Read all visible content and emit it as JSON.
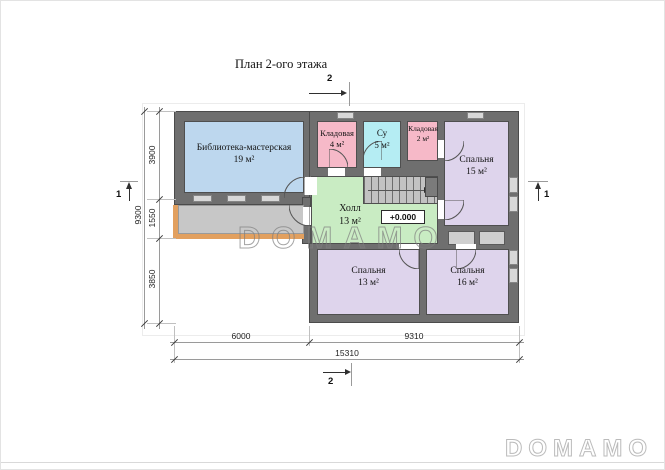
{
  "title": "План 2-ого этажа",
  "level_mark": "+0.000",
  "watermarks": {
    "center": "DOMAMO",
    "corner": "DOMAMO"
  },
  "rooms": {
    "library": {
      "name": "Библиотека-мастерская",
      "area": "19 м²",
      "color": "#bdd7ee"
    },
    "storage1": {
      "name": "Кладовая",
      "area": "4 м²",
      "color": "#f6b9c8"
    },
    "bathroom": {
      "name": "Су",
      "area": "5 м²",
      "color": "#b5edf3"
    },
    "storage2": {
      "name": "Кладовая",
      "area": "2 м²",
      "color": "#f6b9c8"
    },
    "bedroom15": {
      "name": "Спальня",
      "area": "15 м²",
      "color": "#ded4ec"
    },
    "hall": {
      "name": "Холл",
      "area": "13 м²",
      "color": "#c9ecc3"
    },
    "bedroom13": {
      "name": "Спальня",
      "area": "13 м²",
      "color": "#ded4ec"
    },
    "bedroom16": {
      "name": "Спальня",
      "area": "16 м²",
      "color": "#ded4ec"
    }
  },
  "dimensions": {
    "left": {
      "segments": [
        "3900",
        "1550",
        "3850"
      ],
      "total": "9300"
    },
    "bottom": {
      "segments": [
        "6000",
        "9310"
      ],
      "total": "15310"
    }
  },
  "sections": {
    "top": "2",
    "bottom": "2",
    "left": "1",
    "right": "1"
  },
  "colors": {
    "wall": "#6f6f6f",
    "terrace": "#c7c7c7",
    "terrace_trim": "#e2a05f",
    "stairs": "#c2c2c2",
    "window": "#d8d8d8"
  }
}
